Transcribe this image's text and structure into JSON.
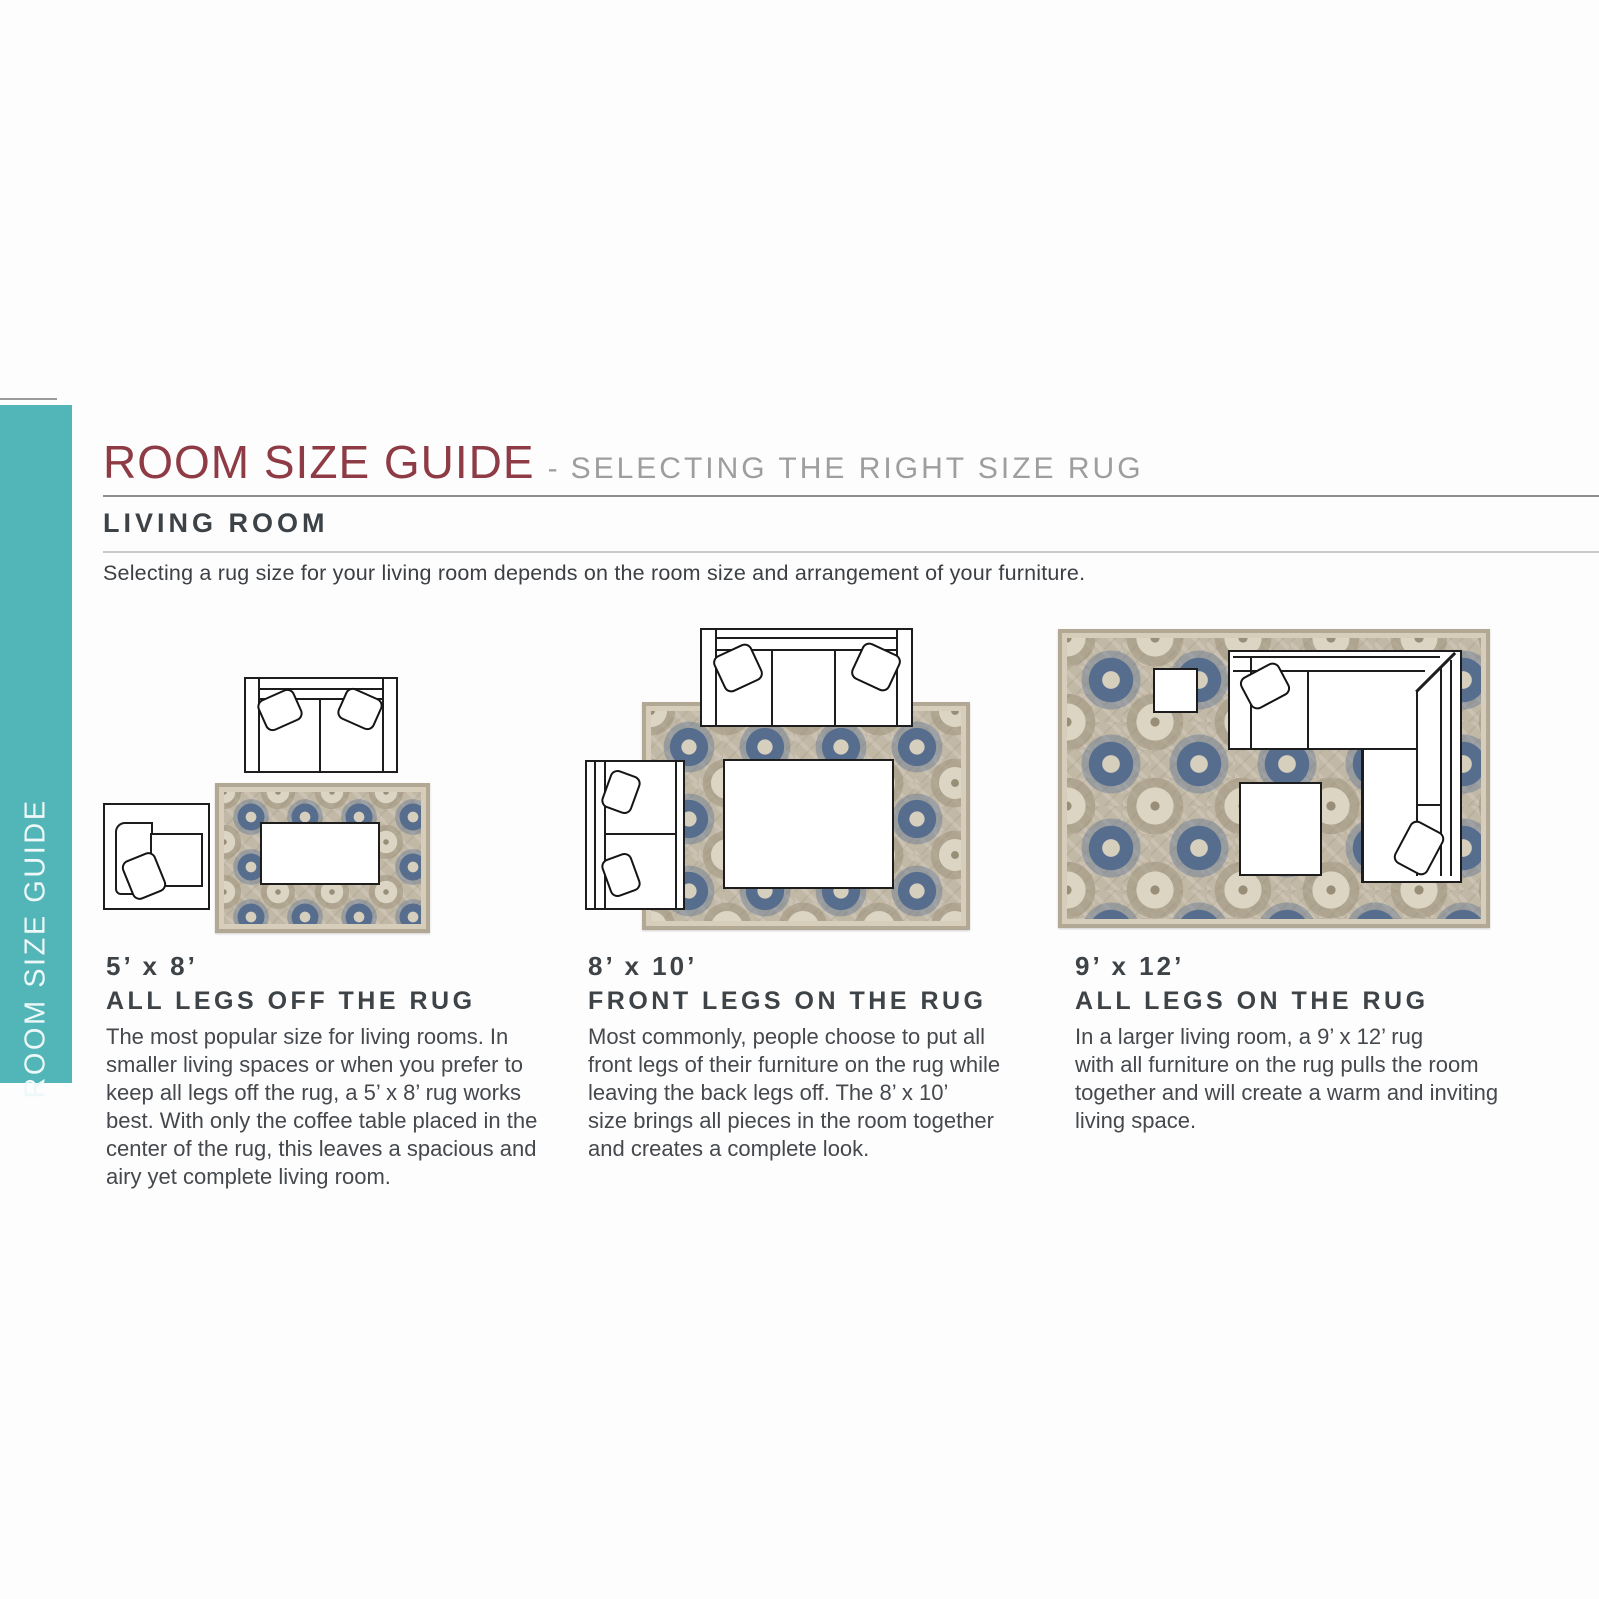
{
  "sidebar": {
    "label": "ROOM SIZE GUIDE",
    "bg_color": "#52b5b7"
  },
  "header": {
    "title": "ROOM SIZE GUIDE",
    "dash": "-",
    "subtitle": "SELECTING THE RIGHT SIZE RUG",
    "section": "LIVING ROOM",
    "description": "Selecting a rug size for your living room depends on the room size and arrangement of your furniture.",
    "title_color": "#8e3b45",
    "subtitle_color": "#9e9e9e"
  },
  "sections": [
    {
      "size": "5’ x 8’",
      "label": "ALL LEGS OFF THE RUG",
      "body": [
        "The most popular size for living rooms. In",
        "smaller living spaces or when you prefer to",
        "keep all legs off the rug, a 5’ x 8’ rug works",
        "best. With only the coffee table placed in the",
        "center of the rug, this leaves a spacious and",
        "airy yet complete living room."
      ]
    },
    {
      "size": "8’ x 10’",
      "label": "FRONT LEGS ON THE RUG",
      "body": [
        "Most commonly, people choose to put all",
        "front legs of their furniture on the rug while",
        "leaving the back legs off. The 8’ x 10’",
        "size brings all pieces in the room together",
        "and creates a complete look."
      ]
    },
    {
      "size": "9’ x 12’",
      "label": "ALL LEGS ON THE RUG",
      "body": [
        "In a larger living room, a 9’ x 12’ rug",
        "with all furniture on the rug pulls the room",
        "together and will create a warm and inviting",
        "living space."
      ]
    }
  ],
  "colors": {
    "rug_base": "#c2b8a6",
    "rug_blue": "#566d8e",
    "rug_cream": "#ddd5c4",
    "heading_gray": "#3e4347",
    "rule_dark": "#8f8f8f",
    "rule_light": "#c9c9c9"
  }
}
